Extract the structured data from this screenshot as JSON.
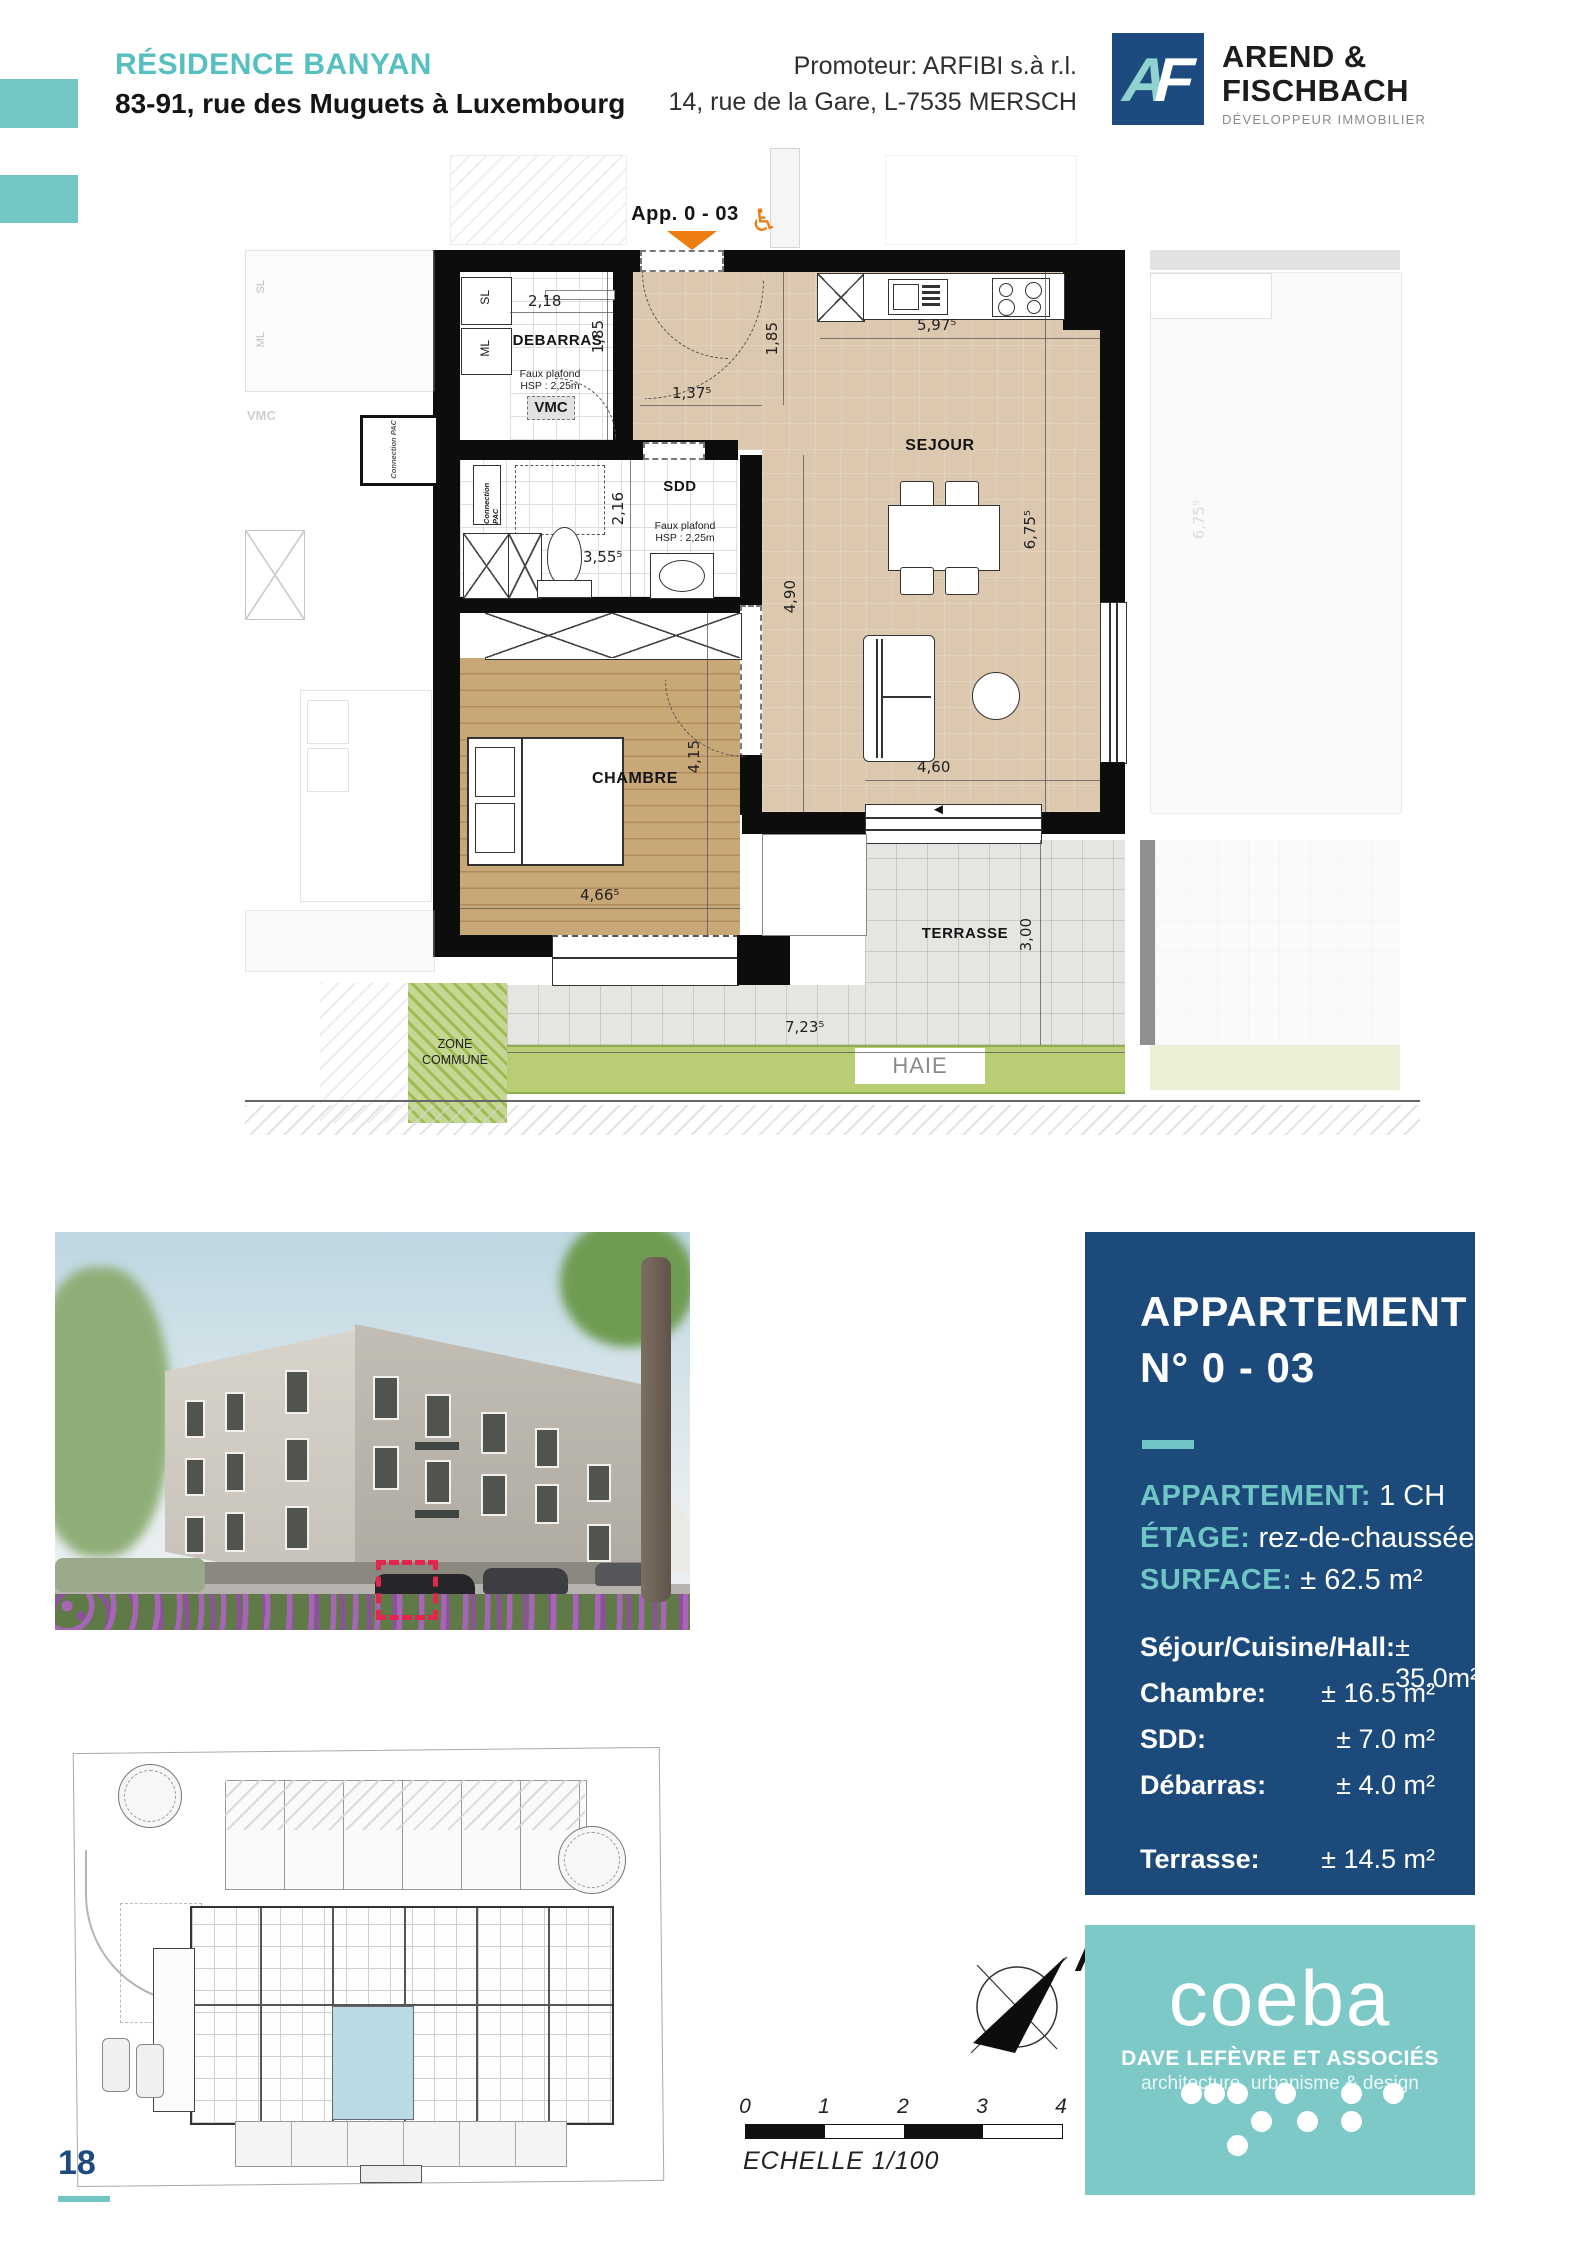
{
  "header": {
    "residence_name": "RÉSIDENCE BANYAN",
    "residence_address": "83-91, rue des Muguets à Luxembourg",
    "promoter_line1": "Promoteur: ARFIBI s.à r.l.",
    "promoter_line2": "14, rue de la Gare, L-7535 MERSCH",
    "logo_monogram_a": "A",
    "logo_monogram_f": "F",
    "logo_name_line1": "AREND &",
    "logo_name_line2": "FISCHBACH",
    "logo_tagline": "DÉVELOPPEUR IMMOBILIER"
  },
  "plan": {
    "unit_label": "App. 0 - 03",
    "wheelchair_icon": "♿",
    "labels": {
      "debarras": "DEBARRAS",
      "vmc": "VMC",
      "sdd": "SDD",
      "sejour": "SEJOUR",
      "chambre": "CHAMBRE",
      "terrasse": "TERRASSE",
      "zone_commune_line1": "ZONE",
      "zone_commune_line2": "COMMUNE",
      "haie": "HAIE",
      "faux_plafond_line1": "Faux plafond",
      "faux_plafond_line2": "HSP : 2,25m",
      "connection_pac": "Connection PAC",
      "closet_sl": "SL",
      "closet_ml": "ML",
      "neighbor_vmc": "VMC",
      "neighbor_dim": "6,75⁵",
      "terrace_door_arrow": "◄"
    },
    "dims": {
      "debarras_width": "2,18",
      "debarras_depth": "1,85",
      "hall_width": "1,37⁵",
      "hall_depth": "1,85",
      "sejour_width": "5,97⁵",
      "sdd_depth": "2,16",
      "sdd_width": "3,55⁵",
      "sejour_depth_left": "4,90",
      "sejour_depth_right": "6,75⁵",
      "chambre_depth": "4,15",
      "sejour_width_bottom": "4,60",
      "chambre_width": "4,66⁵",
      "terrasse_depth": "3,00",
      "terrasse_width": "7,23⁵"
    }
  },
  "info_panel": {
    "title_line1": "APPARTEMENT",
    "title_line2": "N° 0 - 03",
    "spec_label_type": "APPARTEMENT:",
    "spec_value_type": "1 CH",
    "spec_label_floor": "ÉTAGE:",
    "spec_value_floor": "rez-de-chaussée",
    "spec_label_surface": "SURFACE:",
    "spec_value_surface": "± 62.5 m²",
    "rooms": [
      {
        "label": "Séjour/Cuisine/Hall:",
        "value": "± 35.0m²"
      },
      {
        "label": "Chambre:",
        "value": "± 16.5 m²"
      },
      {
        "label": "SDD:",
        "value": "± 7.0 m²"
      },
      {
        "label": "Débarras:",
        "value": "± 4.0 m²"
      }
    ],
    "terrace_label": "Terrasse:",
    "terrace_value": "± 14.5 m²"
  },
  "compass": {
    "north_label": "N"
  },
  "scale_bar": {
    "ticks": [
      "0",
      "1",
      "2",
      "3",
      "4"
    ],
    "caption": "ECHELLE  1/100"
  },
  "coeba": {
    "brand": "coeba",
    "subtitle": "DAVE LEFÈVRE ET ASSOCIÉS",
    "tagline": "architecture, urbanisme & design"
  },
  "footer": {
    "page_number": "18"
  },
  "colors": {
    "teal": "#6fc6c5",
    "navy": "#1b4a7b",
    "orange": "#ee7d11",
    "plan_beige": "#dcc8ae",
    "plan_wood": "#c8a676",
    "haie_green": "#b9ce74",
    "marker_red": "#e3264e"
  }
}
